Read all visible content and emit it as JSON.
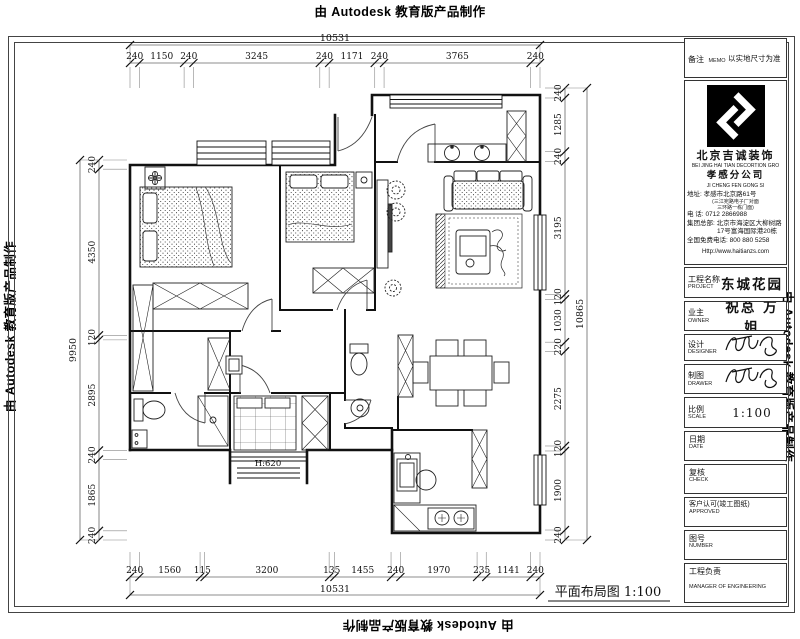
{
  "watermark": {
    "text": "由 Autodesk 教育版产品制作"
  },
  "plan": {
    "title": "平面布局图 1:100",
    "bay_window_label": "H:620"
  },
  "dimensions": {
    "top": {
      "total": "10531",
      "segments": [
        "240",
        "1150",
        "240",
        "3245",
        "240",
        "1171",
        "240",
        "3765",
        "240"
      ]
    },
    "bottom": {
      "total": "10531",
      "segments": [
        "240",
        "1560",
        "115",
        "3200",
        "135",
        "1455",
        "240",
        "1970",
        "235",
        "1141",
        "240"
      ]
    },
    "left": {
      "total": "9950",
      "segments": [
        "240",
        "4350",
        "120",
        "2895",
        "240",
        "1865",
        "240"
      ]
    },
    "right": {
      "total": "10865",
      "segments": [
        "240",
        "1285",
        "240",
        "3195",
        "120",
        "1030",
        "220",
        "2275",
        "120",
        "1900",
        "240"
      ]
    }
  },
  "title_block": {
    "memo": {
      "label_cn": "备注",
      "label_en": "MEMO",
      "value": "以实地尺寸为准"
    },
    "company": {
      "name_cn": "北京吉诚装饰",
      "name_en": "BEI JING HAI TIAN DECORTION GRO",
      "branch_cn": "孝感分公司",
      "branch_en": "JI CHENG FEN GONG SI",
      "address_label": "地址:",
      "address": "孝感市北京路61号",
      "address_note_1": "(三江宛路电子厂对面",
      "address_note_2": "三环路一栋门面)",
      "phone_label": "电  话:",
      "phone": "0712 2866988",
      "hq_label": "集团总部:",
      "hq_line1": "北京市海淀区大柳树路",
      "hq_line2": "17号富海国际港20栋",
      "hotline_label": "全国免费电话:",
      "hotline": "800 880 5258",
      "website": "Http://www.haitianzs.com"
    },
    "project": {
      "label_cn": "工程名称",
      "label_en": "PROJECT",
      "value": "东城花园"
    },
    "owner": {
      "label_cn": "业主",
      "label_en": "OWNER",
      "value": "祝总 万姐"
    },
    "designer": {
      "label_cn": "设计",
      "label_en": "DESIGNER"
    },
    "drawer": {
      "label_cn": "制图",
      "label_en": "DRAWER"
    },
    "scale": {
      "label_cn": "比例",
      "label_en": "SCALE",
      "value": "1:100"
    },
    "date": {
      "label_cn": "日期",
      "label_en": "DATE"
    },
    "check": {
      "label_cn": "复核",
      "label_en": "CHECK"
    },
    "approved": {
      "label_cn": "客户认可(竣工图纸)",
      "label_en": "APPROVED"
    },
    "number": {
      "label_cn": "图号",
      "label_en": "NUMBER"
    },
    "manager": {
      "label_cn": "工程负责",
      "label_en": "MANAGER OF ENGINEERING"
    }
  }
}
